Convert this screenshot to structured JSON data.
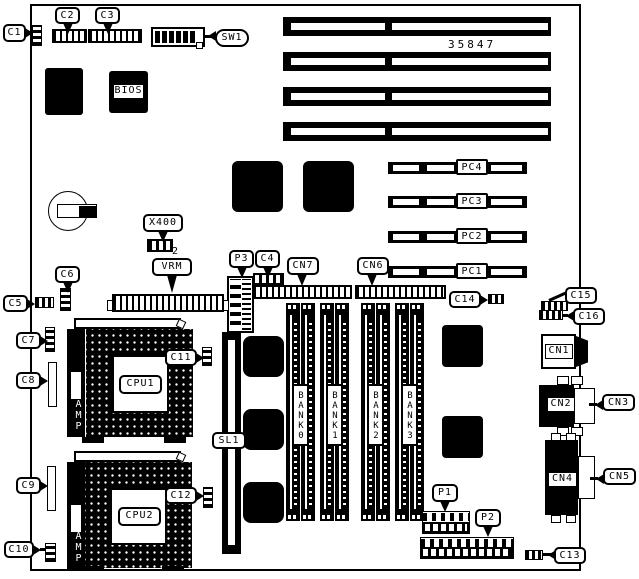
{
  "figure": {
    "part_number": "35847"
  },
  "labels": {
    "c1": "C1",
    "c2": "C2",
    "c3": "C3",
    "c4": "C4",
    "c5": "C5",
    "c6": "C6",
    "c7": "C7",
    "c8": "C8",
    "c9": "C9",
    "c10": "C10",
    "c11": "C11",
    "c12": "C12",
    "c13": "C13",
    "c14": "C14",
    "c15": "C15",
    "c16": "C16",
    "sw1": "SW1",
    "x400": "X400",
    "x400_sub": "2",
    "vrm": "VRM",
    "p1": "P1",
    "p2": "P2",
    "p3": "P3",
    "cn1": "CN1",
    "cn2": "CN2",
    "cn3": "CN3",
    "cn4": "CN4",
    "cn5": "CN5",
    "cn6": "CN6",
    "cn7": "CN7",
    "sl1": "SL1"
  },
  "chips": {
    "bios": "BIOS",
    "cpu1": "CPU1",
    "cpu2": "CPU2"
  },
  "pci_slots": [
    "PC4",
    "PC3",
    "PC2",
    "PC1"
  ],
  "memory_banks": [
    "BANK0",
    "BANK1",
    "BANK2",
    "BANK3"
  ],
  "amp": "AMP",
  "colors": {
    "ink": "#000000",
    "paper": "#ffffff"
  }
}
